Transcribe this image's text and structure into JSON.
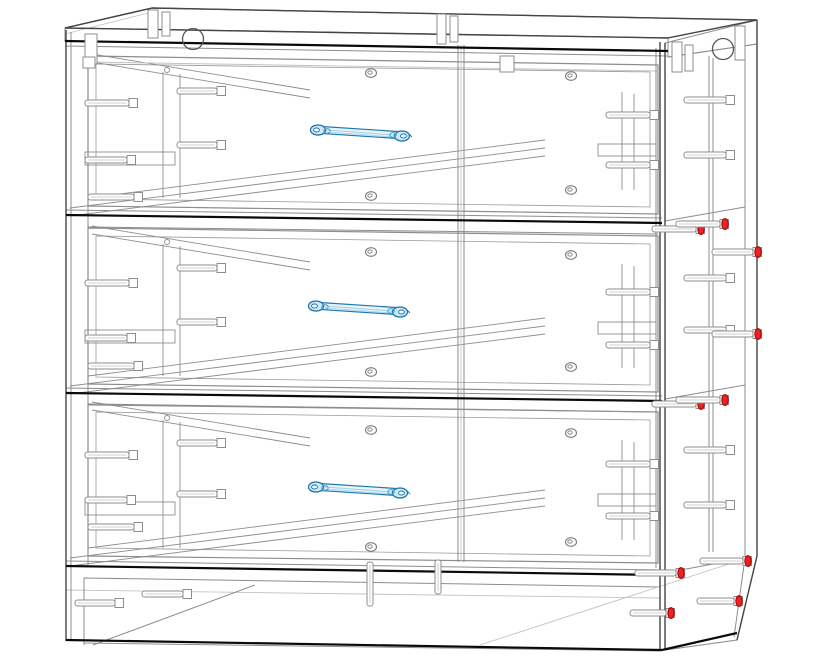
{
  "canvas": {
    "width": 824,
    "height": 658,
    "background": "#ffffff"
  },
  "palette": {
    "black": "#0a0a0a",
    "dark": "#454545",
    "gray": "#8d8d8d",
    "light": "#c2c2c2",
    "fill": "#ffffff",
    "handle_dark": "#1f78ad",
    "handle_mid": "#4a9cc9",
    "handle_light": "#9fd1e8",
    "handle_fill": "#e8f4fb",
    "handle_cap": "#cfe9f6",
    "red_fill": "#ee2222",
    "red_stroke": "#a00000"
  },
  "model": {
    "name": "three-drawer-chest-wireframe",
    "view": "front-right perspective, x-ray wireframe",
    "drawer_count": 3,
    "polygons": [
      {
        "name": "top-face",
        "points": "65,28 152,8 757,20 668,38",
        "fill": "#ffffff",
        "stroke": "#454545",
        "w": 1.2
      },
      {
        "name": "top-front-band",
        "points": "65,28 668,38 668,51 65,41",
        "fill": "#ffffff",
        "stroke": "#8d8d8d",
        "w": 1
      },
      {
        "name": "top-right-end",
        "points": "668,38 757,20 757,44 668,57",
        "fill": "#ffffff",
        "stroke": "#8d8d8d",
        "w": 1
      },
      {
        "name": "right-panel",
        "points": "665,43 757,20 757,556 737,640 665,650",
        "fill": "none",
        "stroke": "#8d8d8d",
        "w": 1
      },
      {
        "name": "plinth-front",
        "points": "84,578 660,587 660,651 84,643",
        "fill": "none",
        "stroke": "#8d8d8d",
        "w": 1
      }
    ],
    "lines": {
      "black": [
        [
          65,
          41,
          668,
          51
        ],
        [
          66,
          215,
          662,
          223
        ],
        [
          66,
          393,
          662,
          401
        ],
        [
          66,
          566,
          662,
          575
        ],
        [
          66,
          640,
          662,
          650
        ],
        [
          662,
          650,
          737,
          633
        ]
      ],
      "dark": [
        [
          65,
          28,
          668,
          38
        ],
        [
          152,
          8,
          757,
          20
        ],
        [
          65,
          28,
          152,
          8
        ],
        [
          668,
          38,
          757,
          20
        ],
        [
          66,
          30,
          66,
          641
        ],
        [
          660,
          42,
          660,
          650
        ],
        [
          665,
          43,
          665,
          650
        ],
        [
          757,
          20,
          757,
          556
        ],
        [
          757,
          556,
          737,
          640
        ]
      ],
      "gray": [
        [
          65,
          46,
          668,
          56
        ],
        [
          71,
          32,
          71,
          641
        ],
        [
          88,
          56,
          88,
          566
        ],
        [
          656,
          48,
          656,
          568
        ],
        [
          745,
          32,
          745,
          558
        ],
        [
          745,
          558,
          734,
          637
        ],
        [
          709,
          56,
          709,
          552
        ],
        [
          713,
          58,
          713,
          552
        ],
        [
          458,
          45,
          458,
          562
        ],
        [
          464,
          45,
          464,
          562
        ],
        [
          66,
          210,
          662,
          218
        ],
        [
          88,
          227,
          658,
          234
        ],
        [
          665,
          221,
          745,
          207
        ],
        [
          66,
          388,
          662,
          396
        ],
        [
          88,
          405,
          658,
          412
        ],
        [
          665,
          399,
          745,
          385
        ],
        [
          66,
          561,
          662,
          570
        ],
        [
          665,
          573,
          745,
          558
        ],
        [
          84,
          578,
          84,
          645
        ],
        [
          93,
          645,
          255,
          585
        ],
        [
          668,
          57,
          757,
          44
        ]
      ],
      "light": [
        [
          65,
          34,
          152,
          12
        ],
        [
          66,
          590,
          660,
          598
        ],
        [
          480,
          645,
          735,
          562
        ],
        [
          461,
          45,
          461,
          562
        ],
        [
          88,
          62,
          658,
          71
        ]
      ]
    },
    "drawers": [
      {
        "name": "drawer-1",
        "front_outer": "88,56 658,65 658,214 88,206",
        "front_inner": "96,64 650,72 650,207 96,199",
        "wire": [
          [
            163,
            72,
            163,
            198
          ],
          [
            180,
            74,
            180,
            198
          ],
          [
            622,
            92,
            622,
            190
          ],
          [
            634,
            94,
            634,
            190
          ],
          [
            70,
            216,
            545,
            156
          ],
          [
            70,
            208,
            545,
            148
          ],
          [
            88,
            198,
            545,
            140
          ],
          [
            92,
            54,
            310,
            90
          ],
          [
            92,
            62,
            310,
            98
          ]
        ],
        "brackets": [
          [
            85,
            152,
            90,
            13
          ],
          [
            598,
            144,
            58,
            12
          ]
        ],
        "cams": [
          [
            371,
            73
          ],
          [
            371,
            196
          ],
          [
            571,
            76
          ],
          [
            571,
            190
          ]
        ],
        "cams_small": [
          [
            167,
            70
          ]
        ],
        "handle": {
          "x": 312,
          "y": 130
        }
      },
      {
        "name": "drawer-2",
        "front_outer": "88,228 658,236 658,392 88,384",
        "front_inner": "96,236 650,244 650,385 96,377",
        "wire": [
          [
            163,
            244,
            163,
            376
          ],
          [
            180,
            246,
            180,
            376
          ],
          [
            622,
            264,
            622,
            368
          ],
          [
            634,
            266,
            634,
            368
          ],
          [
            70,
            394,
            545,
            334
          ],
          [
            70,
            386,
            545,
            326
          ],
          [
            88,
            376,
            545,
            318
          ],
          [
            92,
            226,
            310,
            262
          ],
          [
            92,
            234,
            310,
            270
          ]
        ],
        "brackets": [
          [
            85,
            330,
            90,
            13
          ],
          [
            598,
            322,
            58,
            12
          ]
        ],
        "cams": [
          [
            371,
            252
          ],
          [
            371,
            372
          ],
          [
            571,
            255
          ],
          [
            571,
            367
          ]
        ],
        "cams_small": [
          [
            167,
            242
          ]
        ],
        "handle": {
          "x": 310,
          "y": 306
        }
      },
      {
        "name": "drawer-3",
        "front_outer": "88,404 658,412 658,563 88,556",
        "front_inner": "96,412 650,420 650,556 96,548",
        "wire": [
          [
            163,
            420,
            163,
            548
          ],
          [
            180,
            422,
            180,
            548
          ],
          [
            622,
            440,
            622,
            540
          ],
          [
            634,
            442,
            634,
            540
          ],
          [
            70,
            566,
            545,
            506
          ],
          [
            70,
            558,
            545,
            498
          ],
          [
            88,
            548,
            545,
            490
          ],
          [
            92,
            402,
            310,
            438
          ],
          [
            92,
            410,
            310,
            446
          ]
        ],
        "brackets": [
          [
            85,
            502,
            90,
            13
          ],
          [
            598,
            494,
            58,
            12
          ]
        ],
        "cams": [
          [
            371,
            430
          ],
          [
            371,
            547
          ],
          [
            571,
            433
          ],
          [
            571,
            542
          ]
        ],
        "cams_small": [
          [
            167,
            418
          ]
        ],
        "handle": {
          "x": 310,
          "y": 487
        }
      }
    ],
    "fasteners": {
      "screws_gray": [
        [
          85,
          103,
          44
        ],
        [
          85,
          160,
          42
        ],
        [
          88,
          197,
          46
        ],
        [
          85,
          283,
          44
        ],
        [
          85,
          338,
          42
        ],
        [
          88,
          366,
          46
        ],
        [
          85,
          455,
          44
        ],
        [
          85,
          500,
          42
        ],
        [
          88,
          527,
          46
        ],
        [
          177,
          91,
          40
        ],
        [
          177,
          145,
          40
        ],
        [
          177,
          268,
          40
        ],
        [
          177,
          322,
          40
        ],
        [
          177,
          443,
          40
        ],
        [
          177,
          494,
          40
        ],
        [
          606,
          115,
          44
        ],
        [
          606,
          165,
          44
        ],
        [
          606,
          292,
          44
        ],
        [
          606,
          345,
          44
        ],
        [
          606,
          464,
          44
        ],
        [
          606,
          516,
          44
        ],
        [
          684,
          100,
          42
        ],
        [
          684,
          155,
          42
        ],
        [
          684,
          278,
          42
        ],
        [
          684,
          330,
          42
        ],
        [
          684,
          450,
          42
        ],
        [
          684,
          505,
          42
        ],
        [
          75,
          603,
          40
        ],
        [
          142,
          594,
          41
        ]
      ],
      "screws_red": [
        [
          652,
          229,
          44
        ],
        [
          676,
          224,
          44
        ],
        [
          712,
          252,
          41
        ],
        [
          712,
          334,
          41
        ],
        [
          652,
          404,
          44
        ],
        [
          676,
          400,
          44
        ],
        [
          700,
          561,
          43
        ],
        [
          635,
          573,
          41
        ],
        [
          697,
          601,
          37
        ],
        [
          630,
          613,
          36
        ]
      ],
      "dowels_vertical": [
        [
          370,
          562,
          44
        ],
        [
          438,
          560,
          34
        ]
      ],
      "cam_housings": [
        [
          193,
          39,
          10.5
        ],
        [
          723,
          49,
          10.5
        ]
      ],
      "top_brackets": [
        [
          148,
          10,
          10,
          28
        ],
        [
          162,
          12,
          8,
          24
        ],
        [
          437,
          14,
          9,
          30
        ],
        [
          450,
          16,
          8,
          26
        ],
        [
          672,
          42,
          10,
          30
        ],
        [
          685,
          45,
          8,
          26
        ],
        [
          735,
          26,
          10,
          34
        ],
        [
          85,
          34,
          12,
          30
        ],
        [
          83,
          57,
          12,
          11
        ],
        [
          500,
          56,
          14,
          16
        ]
      ]
    }
  }
}
